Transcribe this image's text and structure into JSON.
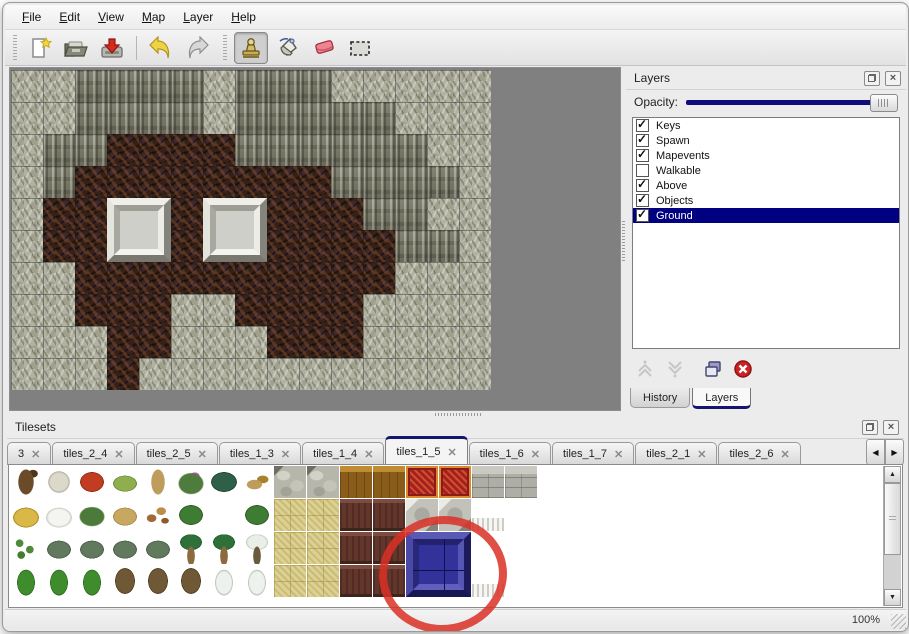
{
  "window": {
    "background": "#ececec",
    "accent": "#000080"
  },
  "menu": {
    "items": [
      "File",
      "Edit",
      "View",
      "Map",
      "Layer",
      "Help"
    ]
  },
  "toolbar": {
    "groups": [
      {
        "tools": [
          {
            "name": "new",
            "icon": "new-file-icon"
          },
          {
            "name": "open",
            "icon": "open-folder-icon"
          },
          {
            "name": "save",
            "icon": "save-icon"
          },
          {
            "name": "undo",
            "icon": "undo-icon",
            "separator_before": true
          },
          {
            "name": "redo",
            "icon": "redo-icon"
          }
        ]
      },
      {
        "tools": [
          {
            "name": "stamp",
            "icon": "stamp-tool-icon",
            "selected": true
          },
          {
            "name": "fill",
            "icon": "fill-tool-icon"
          },
          {
            "name": "eraser",
            "icon": "eraser-tool-icon"
          },
          {
            "name": "select",
            "icon": "select-tool-icon"
          }
        ]
      }
    ]
  },
  "map_view": {
    "tile_size": 32,
    "columns": 15,
    "rows": 10,
    "legend": {
      "h": "rock",
      "c": "cliff-wall",
      "f": "dirt-floor"
    },
    "grid": [
      "hhcccchccchhhhh",
      "hhcccchccccchhh",
      "hccffffcccccchh",
      "hcffffffffcccch",
      "hffffffffffcchh",
      "hfffffffffffcch",
      "hhffffffffffhhh",
      "hhfffhhffffhhhh",
      "hhhffhhhfffhhhh",
      "hhhfhhhhhhhhhhh"
    ],
    "pedestals": [
      {
        "col": 3,
        "row": 4
      },
      {
        "col": 6,
        "row": 4
      }
    ]
  },
  "layers_panel": {
    "title": "Layers",
    "opacity_label": "Opacity:",
    "opacity_percent": 100,
    "layers": [
      {
        "name": "Keys",
        "checked": true,
        "selected": false
      },
      {
        "name": "Spawn",
        "checked": true,
        "selected": false
      },
      {
        "name": "Mapevents",
        "checked": true,
        "selected": false
      },
      {
        "name": "Walkable",
        "checked": false,
        "selected": false
      },
      {
        "name": "Above",
        "checked": true,
        "selected": false
      },
      {
        "name": "Objects",
        "checked": true,
        "selected": false
      },
      {
        "name": "Ground",
        "checked": true,
        "selected": true
      }
    ],
    "actions": [
      "move-layer-up",
      "move-layer-down",
      "duplicate-layer",
      "delete-layer"
    ],
    "tabs": [
      "History",
      "Layers"
    ],
    "active_tab": "Layers"
  },
  "tilesets_panel": {
    "title": "Tilesets",
    "tabs": [
      "3",
      "tiles_2_4",
      "tiles_2_5",
      "tiles_1_3",
      "tiles_1_4",
      "tiles_1_5",
      "tiles_1_6",
      "tiles_1_7",
      "tiles_2_1",
      "tiles_2_6"
    ],
    "active_tab": "tiles_1_5",
    "grid": [
      [
        "trunk",
        "branch",
        "flower-red",
        "stump",
        "trunk-tan",
        "flower-purple",
        "fern",
        "twig",
        "cobble",
        "cobble",
        "wood",
        "wood",
        "carpet",
        "carpet",
        "stone",
        "stone"
      ],
      [
        "hay",
        "snow-mound",
        "flower-orange",
        "grass",
        "leaves",
        "lilypad",
        "flower-pink",
        "lilypad",
        "tan",
        "tan",
        "brown",
        "brown",
        "pillar",
        "pillar",
        "ruffle",
        "blank"
      ],
      [
        "sprouts",
        "bush",
        "bush",
        "bush",
        "bush",
        "palm",
        "palm",
        "snow-palm",
        "tan",
        "tan",
        "brown",
        "brown",
        "sel",
        "sel",
        "blank",
        "blank"
      ],
      [
        "conifer",
        "conifer",
        "conifer",
        "dead-tree",
        "dead-tree",
        "dead-tree",
        "snow-conifer",
        "snow-conifer",
        "tan",
        "tan",
        "brown",
        "brown",
        "sel",
        "sel",
        "ruffle",
        "blank"
      ]
    ],
    "selected_tile": {
      "col": 12,
      "row": 2,
      "span": 2
    }
  },
  "status_bar": {
    "zoom": "100%"
  },
  "annotation": {
    "type": "red-circle",
    "color": "#db3026"
  }
}
